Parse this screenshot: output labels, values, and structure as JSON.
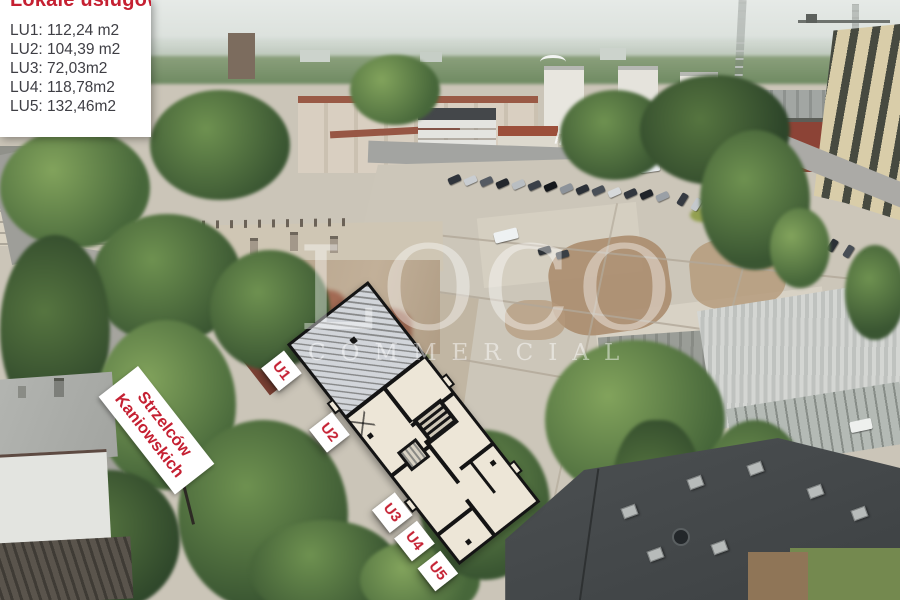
{
  "legend": {
    "title": "Lokale usługowe:",
    "items": [
      "LU1: 112,24 m2",
      "LU2: 104,39 m2",
      "LU3: 72,03m2",
      "LU4: 118,78m2",
      "LU5: 132,46m2"
    ]
  },
  "street_sign": {
    "line1": "Strzelców",
    "line2": "Kaniowskich"
  },
  "plan": {
    "unit_labels": [
      "U1",
      "U2",
      "U3",
      "U4",
      "U5"
    ]
  },
  "watermark": {
    "brand": "LOCO",
    "tagline": "COMMERCIAL"
  },
  "colors": {
    "accent_red": "#c52032",
    "legend_text": "#3e3e44",
    "plan_fill": "#ede6d7",
    "plan_wall": "#141414",
    "label_bg": "#ffffff"
  }
}
